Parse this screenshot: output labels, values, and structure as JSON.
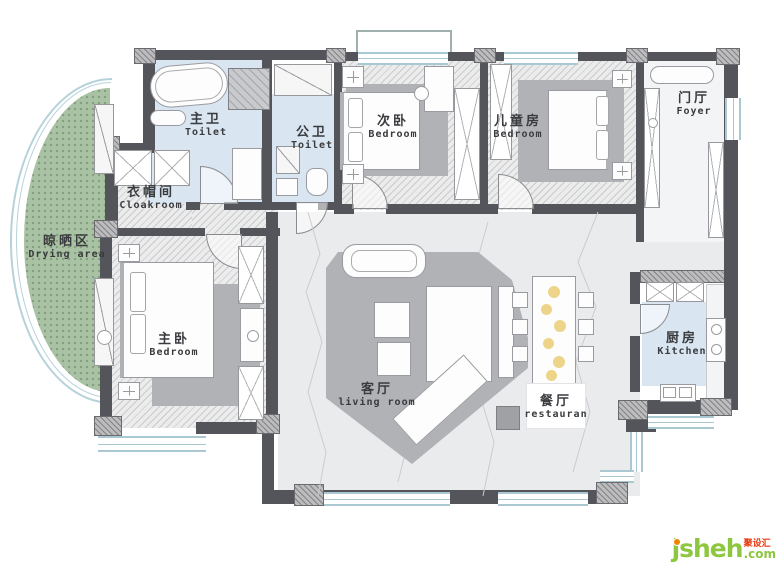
{
  "rooms": [
    {
      "id": "master-toilet",
      "zh": "主卫",
      "en": "Toilet"
    },
    {
      "id": "public-toilet",
      "zh": "公卫",
      "en": "Toilet"
    },
    {
      "id": "second-bedroom",
      "zh": "次卧",
      "en": "Bedroom"
    },
    {
      "id": "kids-room",
      "zh": "儿童房",
      "en": "Bedroom"
    },
    {
      "id": "foyer",
      "zh": "门厅",
      "en": "Foyer"
    },
    {
      "id": "cloakroom",
      "zh": "衣帽间",
      "en": "Cloakroom"
    },
    {
      "id": "drying-area",
      "zh": "晾晒区",
      "en": "Drying area"
    },
    {
      "id": "master-bedroom",
      "zh": "主卧",
      "en": "Bedroom"
    },
    {
      "id": "living-room",
      "zh": "客厅",
      "en": "living room"
    },
    {
      "id": "dining-room",
      "zh": "餐厅",
      "en": "restauran"
    },
    {
      "id": "kitchen",
      "zh": "厨房",
      "en": "Kitchen"
    }
  ],
  "watermark": {
    "brand": "jsheh",
    "suffix": ".com",
    "tagline": "聚设汇"
  },
  "colors": {
    "wall": "#54555a",
    "bath_floor": "#d9e6f2",
    "drying_floor": "#a9c2a3",
    "marble_floor": "#eaebed",
    "rug": "#b0b2b5",
    "window_line": "#a9c8d2",
    "flower_accent": "#e8c96a",
    "logo_green": "#8dc63f",
    "logo_orange": "#f08300",
    "logo_red": "#e8380d"
  },
  "icons": {
    "bathtub": "rounded-oval",
    "shower": "hatched-square",
    "dining-flowers": "yellow-dots",
    "cabinet": "x-cross-box",
    "nightstand": "cross-box",
    "washer": "circle-in-box"
  }
}
